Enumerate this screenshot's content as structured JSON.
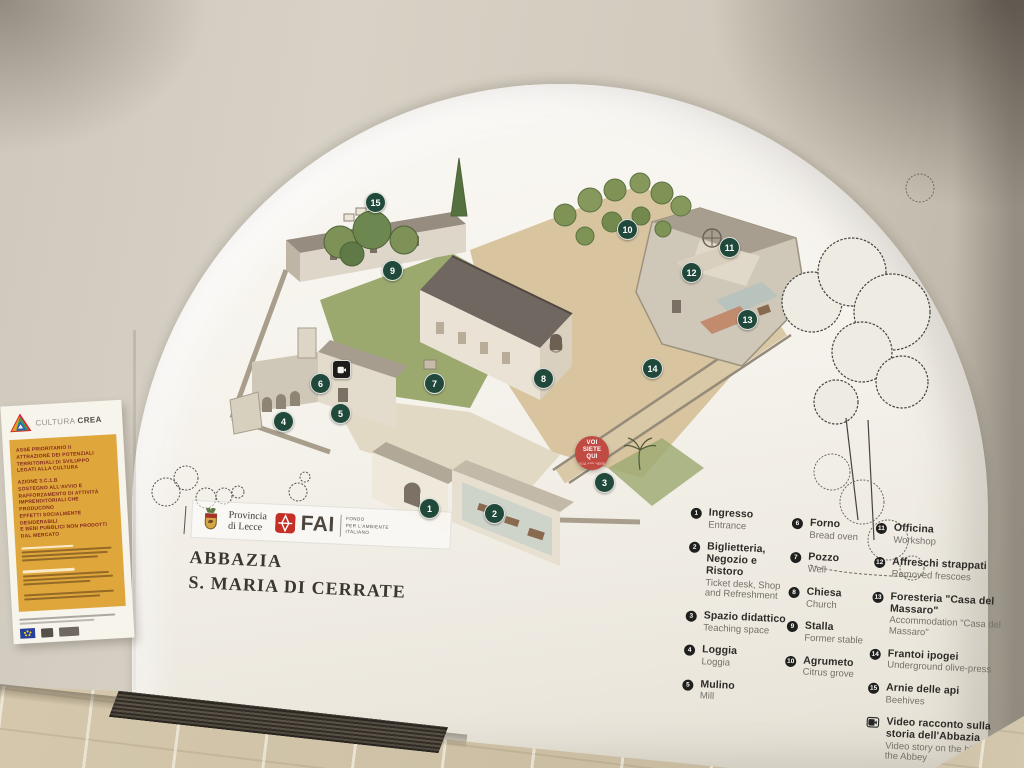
{
  "poster": {
    "brand_light": "CULTURA",
    "brand_bold": "CREA",
    "heading1": "ASSE PRIORITARIO II\nATTRAZIONE DEI POTENZIALI\nTERRITORIALI DI SVILUPPO\nLEGATI ALLA CULTURA",
    "heading2": "AZIONE 3.C.1.B\nSOSTEGNO ALL'AVVIO E\nRAFFORZAMENTO DI ATTIVITÀ\nIMPRENDITORIALI CHE PRODUCONO\nEFFETTI SOCIALMENTE DESIDERABILI\nE BENI PUBBLICI NON PRODOTTI\nDAL MERCATO"
  },
  "mural": {
    "provincia_logo": "Provincia\ndi Lecce",
    "fai_acronym": "FAI",
    "fai_full": "FONDO\nPER L'AMBIENTE\nITALIANO",
    "title_line1": "ABBAZIA",
    "title_line2": "S. MARIA DI CERRATE",
    "you_are_here_it": "VOI\nSIETE\nQUI",
    "you_are_here_en": "YOU ARE HERE",
    "marker_color": "#20493c",
    "you_are_here_color": "#bf4b43",
    "markers": [
      {
        "n": "1",
        "x": 429,
        "y": 508
      },
      {
        "n": "2",
        "x": 494,
        "y": 513
      },
      {
        "n": "3",
        "x": 604,
        "y": 482
      },
      {
        "n": "4",
        "x": 283,
        "y": 421
      },
      {
        "n": "5",
        "x": 340,
        "y": 413
      },
      {
        "n": "6",
        "x": 320,
        "y": 383
      },
      {
        "n": "7",
        "x": 434,
        "y": 383
      },
      {
        "n": "8",
        "x": 543,
        "y": 378
      },
      {
        "n": "9",
        "x": 392,
        "y": 270
      },
      {
        "n": "10",
        "x": 627,
        "y": 229
      },
      {
        "n": "11",
        "x": 729,
        "y": 247
      },
      {
        "n": "12",
        "x": 691,
        "y": 272
      },
      {
        "n": "13",
        "x": 747,
        "y": 319
      },
      {
        "n": "14",
        "x": 652,
        "y": 368
      },
      {
        "n": "15",
        "x": 375,
        "y": 202
      },
      {
        "n": "video",
        "x": 340,
        "y": 368
      }
    ],
    "legend_columns": [
      {
        "items": [
          {
            "n": "1",
            "it": "Ingresso",
            "en": "Entrance"
          },
          {
            "n": "2",
            "it": "Biglietteria, Negozio e Ristoro",
            "en": "Ticket desk, Shop and Refreshment"
          },
          {
            "n": "3",
            "it": "Spazio didattico",
            "en": "Teaching space"
          },
          {
            "n": "4",
            "it": "Loggia",
            "en": "Loggia"
          },
          {
            "n": "5",
            "it": "Mulino",
            "en": "Mill"
          }
        ]
      },
      {
        "items": [
          {
            "n": "6",
            "it": "Forno",
            "en": "Bread oven"
          },
          {
            "n": "7",
            "it": "Pozzo",
            "en": "Well"
          },
          {
            "n": "8",
            "it": "Chiesa",
            "en": "Church"
          },
          {
            "n": "9",
            "it": "Stalla",
            "en": "Former stable"
          },
          {
            "n": "10",
            "it": "Agrumeto",
            "en": "Citrus grove"
          }
        ]
      },
      {
        "items": [
          {
            "n": "11",
            "it": "Officina",
            "en": "Workshop"
          },
          {
            "n": "12",
            "it": "Affreschi strappati",
            "en": "Removed frescoes"
          },
          {
            "n": "13",
            "it": "Foresteria \"Casa del Massaro\"",
            "en": "Accommodation \"Casa del Massaro\""
          },
          {
            "n": "14",
            "it": "Frantoi ipogei",
            "en": "Underground olive-press"
          },
          {
            "n": "15",
            "it": "Arnie delle api",
            "en": "Beehives"
          },
          {
            "n": "video",
            "it": "Video racconto sulla storia dell'Abbazia",
            "en": "Video story on the history of the Abbey"
          }
        ]
      }
    ]
  }
}
